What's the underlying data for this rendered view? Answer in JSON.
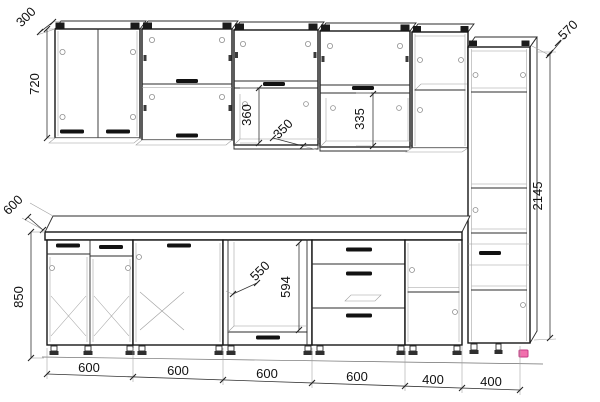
{
  "drawing": {
    "kind": "kitchen-set-technical-line-drawing",
    "background_color": "#ffffff",
    "line_color": "#1b1b1b",
    "highlight_color": "#ef66a9",
    "dims": {
      "wall_cabinet_depth": "300",
      "wall_cabinet_height": "720",
      "open_niche_height_left": "360",
      "open_shelf_depth": "350",
      "open_niche_height_right": "335",
      "tall_cabinet_depth": "570",
      "tall_cabinet_height": "2145",
      "worktop_depth": "600",
      "base_cabinet_height": "850",
      "oven_niche_width": "550",
      "oven_niche_height": "594",
      "module_widths": [
        "600",
        "600",
        "600",
        "600",
        "400",
        "400"
      ]
    }
  }
}
